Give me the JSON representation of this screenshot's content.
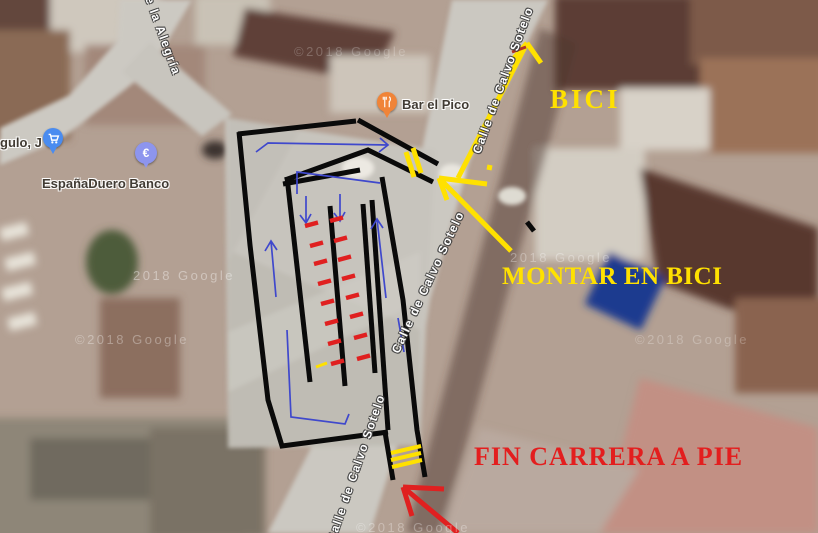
{
  "map": {
    "street_labels": [
      {
        "text": "e la Alegría",
        "x": 163,
        "y": 36,
        "rot": 70
      },
      {
        "text": "Calle de Calvo Sotelo",
        "x": 503,
        "y": 80,
        "rot": -70
      },
      {
        "text": "Calle de Calvo Sotelo",
        "x": 428,
        "y": 282,
        "rot": -65
      },
      {
        "text": "Calle de Calvo Sotelo",
        "x": 356,
        "y": 468,
        "rot": -71
      }
    ],
    "attribution_watermarks": [
      {
        "text": "©2018 Google",
        "x": 294,
        "y": 44,
        "opacity": 0.22
      },
      {
        "text": "2018 Google",
        "x": 133,
        "y": 268,
        "opacity": 0.38
      },
      {
        "text": "©2018 Google",
        "x": 75,
        "y": 332,
        "opacity": 0.32
      },
      {
        "text": "2018 Google",
        "x": 510,
        "y": 250,
        "opacity": 0.3
      },
      {
        "text": "©2018 Google",
        "x": 635,
        "y": 332,
        "opacity": 0.25
      },
      {
        "text": "©2018 Google",
        "x": 356,
        "y": 520,
        "opacity": 0.3
      }
    ],
    "pois": [
      {
        "name": "gulo, J",
        "type": "shopping",
        "pin_color": "#4a8cf0"
      },
      {
        "name": "EspañaDuero Banco",
        "type": "bank",
        "pin_color": "#8d95ee",
        "pin_symbol": "€"
      },
      {
        "name": "Bar el Pico",
        "type": "restaurant",
        "pin_color": "#f08438"
      }
    ]
  },
  "annotations": {
    "texts": [
      {
        "text": "BICI",
        "color": "#FFE100"
      },
      {
        "text": "MONTAR EN BICI",
        "color": "#FFE100"
      },
      {
        "text": "FIN CARRERA A PIE",
        "color": "#E31E1E"
      }
    ],
    "pen_colors": {
      "course": "#0a0a0a",
      "route": "#3f48cc",
      "marks_red": "#e02020",
      "marks_yellow": "#ffe100"
    },
    "course_paths": [
      "M238,134 L356,121",
      "M239,132 L250,245 L268,400 L282,446 L388,432",
      "M358,120 L438,164",
      "M285,180 L368,150 L433,182",
      "M283,184 L360,170",
      "M287,177 L310,382",
      "M330,206 L345,386",
      "M363,204 L375,373",
      "M372,200 L388,430",
      "M382,177 L403,300 L417,430 L425,477",
      "M385,432 L393,480",
      "M527,222 L534,231"
    ],
    "route_paths": [
      "M256,152 L268,143 L388,145 M380,138 L388,145 L379,152",
      "M297,194 L297,172 L380,183",
      "M306,196 L306,223 M300,215 L306,223 L311,214",
      "M340,194 L340,221 M334,213 L340,221 L345,212",
      "M276,297 L271,241 M265,251 L271,241 L277,250",
      "M386,298 L377,219 M371,229 L377,219 L383,228",
      "M287,330 L291,417 L345,424 L349,414",
      "M398,318 L404,352"
    ],
    "yellow_paths": [
      {
        "d": "M406,152 L414,177",
        "w": 5,
        "name": "transition-gate-mark"
      },
      {
        "d": "M413,148 L421,173",
        "w": 5,
        "name": "transition-gate-mark"
      },
      {
        "d": "M391,453 L421,446",
        "w": 4,
        "name": "finish-line-mark"
      },
      {
        "d": "M391,460 L421,453",
        "w": 4,
        "name": "finish-line-mark"
      },
      {
        "d": "M392,467 L422,460",
        "w": 4,
        "name": "finish-line-mark"
      },
      {
        "d": "M458,178 L527,43 M527,43 L541,63 M527,43 L514,58",
        "w": 5,
        "name": "bici-direction-arrow"
      },
      {
        "d": "M439,178 L511,251 M439,178 L487,184 M439,178 L447,200",
        "w": 5,
        "name": "montar-en-bici-arrow"
      },
      {
        "d": "M487,167 l5,1",
        "w": 5,
        "name": "small-yellow-dot"
      },
      {
        "d": "M316,367 l11,-4",
        "w": 3,
        "name": "small-yellow-dash"
      }
    ],
    "red_paths": [
      {
        "d": "M403,487 L458,533 M403,487 L444,489 M403,487 L412,516",
        "w": 5,
        "name": "fin-carrera-arrow"
      },
      {
        "d": "M512,52 L526,47",
        "w": 3,
        "c": "#b03326",
        "name": "small-red-tick"
      }
    ],
    "red_dashes": [
      [
        305,
        226
      ],
      [
        310,
        246
      ],
      [
        314,
        264
      ],
      [
        318,
        284
      ],
      [
        321,
        304
      ],
      [
        325,
        324
      ],
      [
        328,
        344
      ],
      [
        331,
        364
      ],
      [
        330,
        221
      ],
      [
        334,
        241
      ],
      [
        338,
        260
      ],
      [
        342,
        279
      ],
      [
        346,
        298
      ],
      [
        350,
        317
      ],
      [
        354,
        338
      ],
      [
        357,
        359
      ]
    ]
  }
}
